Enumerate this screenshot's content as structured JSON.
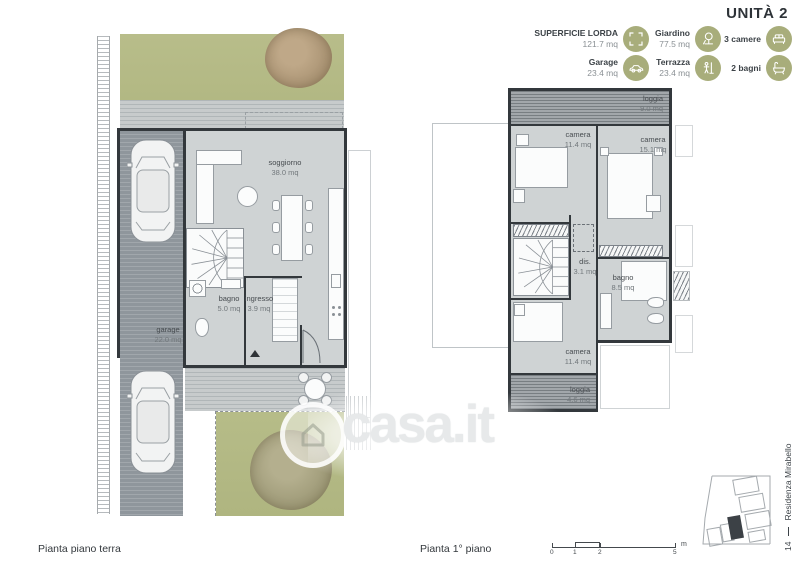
{
  "title": "UNITÀ 2",
  "legend": {
    "items": [
      {
        "label": "SUPERFICIE LORDA",
        "value": "121.7 mq",
        "icon": "area-frame-icon"
      },
      {
        "label": "Giardino",
        "value": "77.5 mq",
        "icon": "garden-tree-icon"
      },
      {
        "label": "3 camere",
        "value": "",
        "icon": "bed-icon"
      },
      {
        "label": "Garage",
        "value": "23.4 mq",
        "icon": "car-icon"
      },
      {
        "label": "Terrazza",
        "value": "23.4 mq",
        "icon": "terrace-person-icon"
      },
      {
        "label": "2 bagni",
        "value": "",
        "icon": "bathtub-icon"
      }
    ]
  },
  "ground_floor": {
    "caption": "Pianta piano terra",
    "rooms": {
      "soggiorno": {
        "name": "soggiorno",
        "area": "38.0 mq"
      },
      "bagno": {
        "name": "bagno",
        "area": "5.0 mq"
      },
      "ingresso": {
        "name": "ingresso",
        "area": "3.9 mq"
      },
      "garage": {
        "name": "garage",
        "area": "22.0 mq"
      }
    }
  },
  "first_floor": {
    "caption": "Pianta 1° piano",
    "rooms": {
      "loggia_top": {
        "name": "loggia",
        "area": "9.0 mq"
      },
      "camera_1": {
        "name": "camera",
        "area": "11.4 mq"
      },
      "camera_2": {
        "name": "camera",
        "area": "15.1 mq"
      },
      "dis": {
        "name": "dis.",
        "area": "3.1 mq"
      },
      "bagno": {
        "name": "bagno",
        "area": "8.5 mq"
      },
      "camera_3": {
        "name": "camera",
        "area": "11.4 mq"
      },
      "loggia_bottom": {
        "name": "loggia",
        "area": "4.6 mq"
      }
    }
  },
  "scale_bar": {
    "ticks": [
      "0",
      "1",
      "2",
      "5"
    ],
    "unit": "m"
  },
  "sidebar": {
    "page": "14",
    "project": "Residenza Mirabello"
  },
  "watermark": {
    "text": "casa.it"
  },
  "colors": {
    "accent_green": "#a8ad7b",
    "garden_green": "#b6bc88",
    "plan_gray": "#cfd3d4",
    "drive_gray": "#8f969c",
    "wall": "#33383c"
  }
}
